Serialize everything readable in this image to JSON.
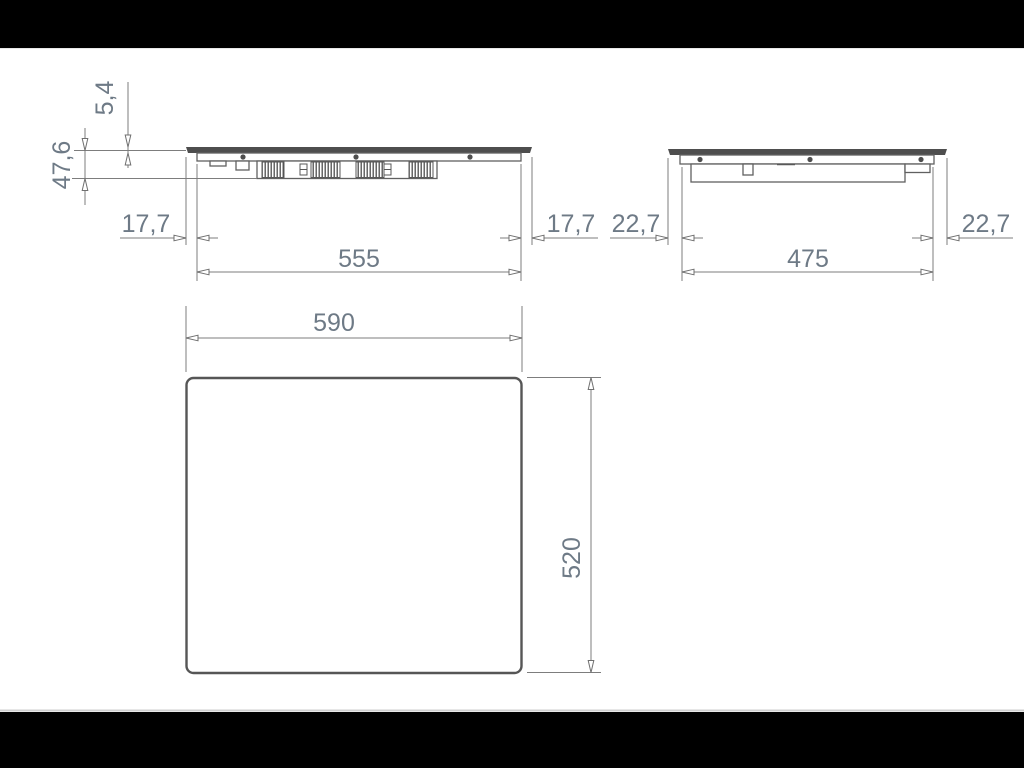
{
  "page": {
    "letterbox_color": "#000000",
    "paper_color": "#ffffff"
  },
  "drawing": {
    "type": "technical-dimension-drawing",
    "front_view": {
      "glass_thickness": "5,4",
      "height": "47,6",
      "left_overhang": "17,7",
      "body_width": "555",
      "right_overhang": "17,7"
    },
    "side_view": {
      "left_overhang": "22,7",
      "body_depth": "475",
      "right_overhang": "22,7"
    },
    "top_view": {
      "overall_width": "590",
      "overall_depth": "520"
    },
    "colors": {
      "line": "#7d7d7d",
      "outline": "#606060",
      "glass_fill": "#4e4e4e",
      "dimension_text": "#6e7a86"
    }
  }
}
